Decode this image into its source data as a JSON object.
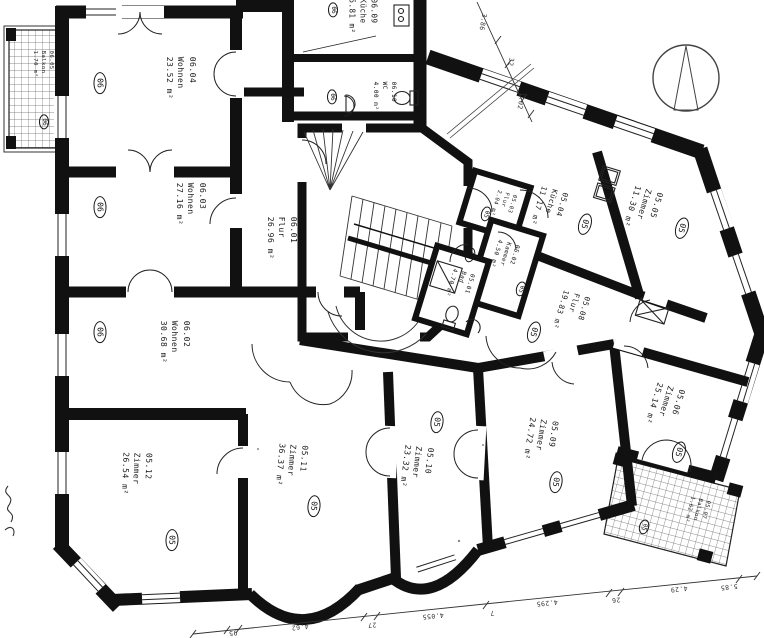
{
  "plan": {
    "type": "architectural-floor-plan",
    "colors": {
      "ink": "#111111",
      "paper": "#ffffff",
      "dim_lines": "#333333",
      "hatch": "#666666"
    },
    "rooms": [
      {
        "id": "06.04",
        "name": "Wohnen",
        "area": "23.52 m²",
        "badge": "06"
      },
      {
        "id": "06.03",
        "name": "Wohnen",
        "area": "27.16 m²",
        "badge": "06"
      },
      {
        "id": "06.02",
        "name": "Wohnen",
        "area": "30.68 m²",
        "badge": "06"
      },
      {
        "id": "06.01",
        "name": "Flur",
        "area": "26.96 m²",
        "badge": ""
      },
      {
        "id": "06.09",
        "name": "Küche",
        "area": "5.81 m²",
        "badge": "06"
      },
      {
        "id": "06.10",
        "name": "WC",
        "area": "4.00 m²",
        "badge": "06"
      },
      {
        "id": "06.05",
        "name": "Balkon",
        "area": "1.70 m²",
        "badge": "06"
      },
      {
        "id": "05.03",
        "name": "Flur",
        "area": "2.04 m²",
        "badge": "05"
      },
      {
        "id": "05.04",
        "name": "Küche",
        "area": "11.17 m²",
        "badge": "05"
      },
      {
        "id": "05.05",
        "name": "Zimmer",
        "area": "11.30 m²",
        "badge": "05"
      },
      {
        "id": "05.02",
        "name": "Kammer",
        "area": "4.50 m²",
        "badge": "05"
      },
      {
        "id": "05.01",
        "name": "Bad",
        "area": "4.70 m²",
        "badge": "05"
      },
      {
        "id": "05.08",
        "name": "Flur",
        "area": "19.83 m²",
        "badge": "05"
      },
      {
        "id": "05.06",
        "name": "Zimmer",
        "area": "25.14 m²",
        "badge": "05"
      },
      {
        "id": "05.07",
        "name": "Balkon",
        "area": "1.62 m²",
        "badge": "05"
      },
      {
        "id": "05.09",
        "name": "Zimmer",
        "area": "24.72 m²",
        "badge": "05"
      },
      {
        "id": "05.10",
        "name": "Zimmer",
        "area": "23.32 m²",
        "badge": "05"
      },
      {
        "id": "05.11",
        "name": "Zimmer",
        "area": "36.37 m²",
        "badge": "05"
      },
      {
        "id": "05.12",
        "name": "Zimmer",
        "area": "26.54 m²",
        "badge": "05"
      }
    ],
    "dimensions": {
      "top": [
        "3.86",
        "32",
        "1.02"
      ],
      "bottom": [
        "95",
        "4.62",
        "27",
        "4.055",
        "7",
        "4.295",
        "26",
        "4.29",
        "5.85"
      ]
    }
  }
}
